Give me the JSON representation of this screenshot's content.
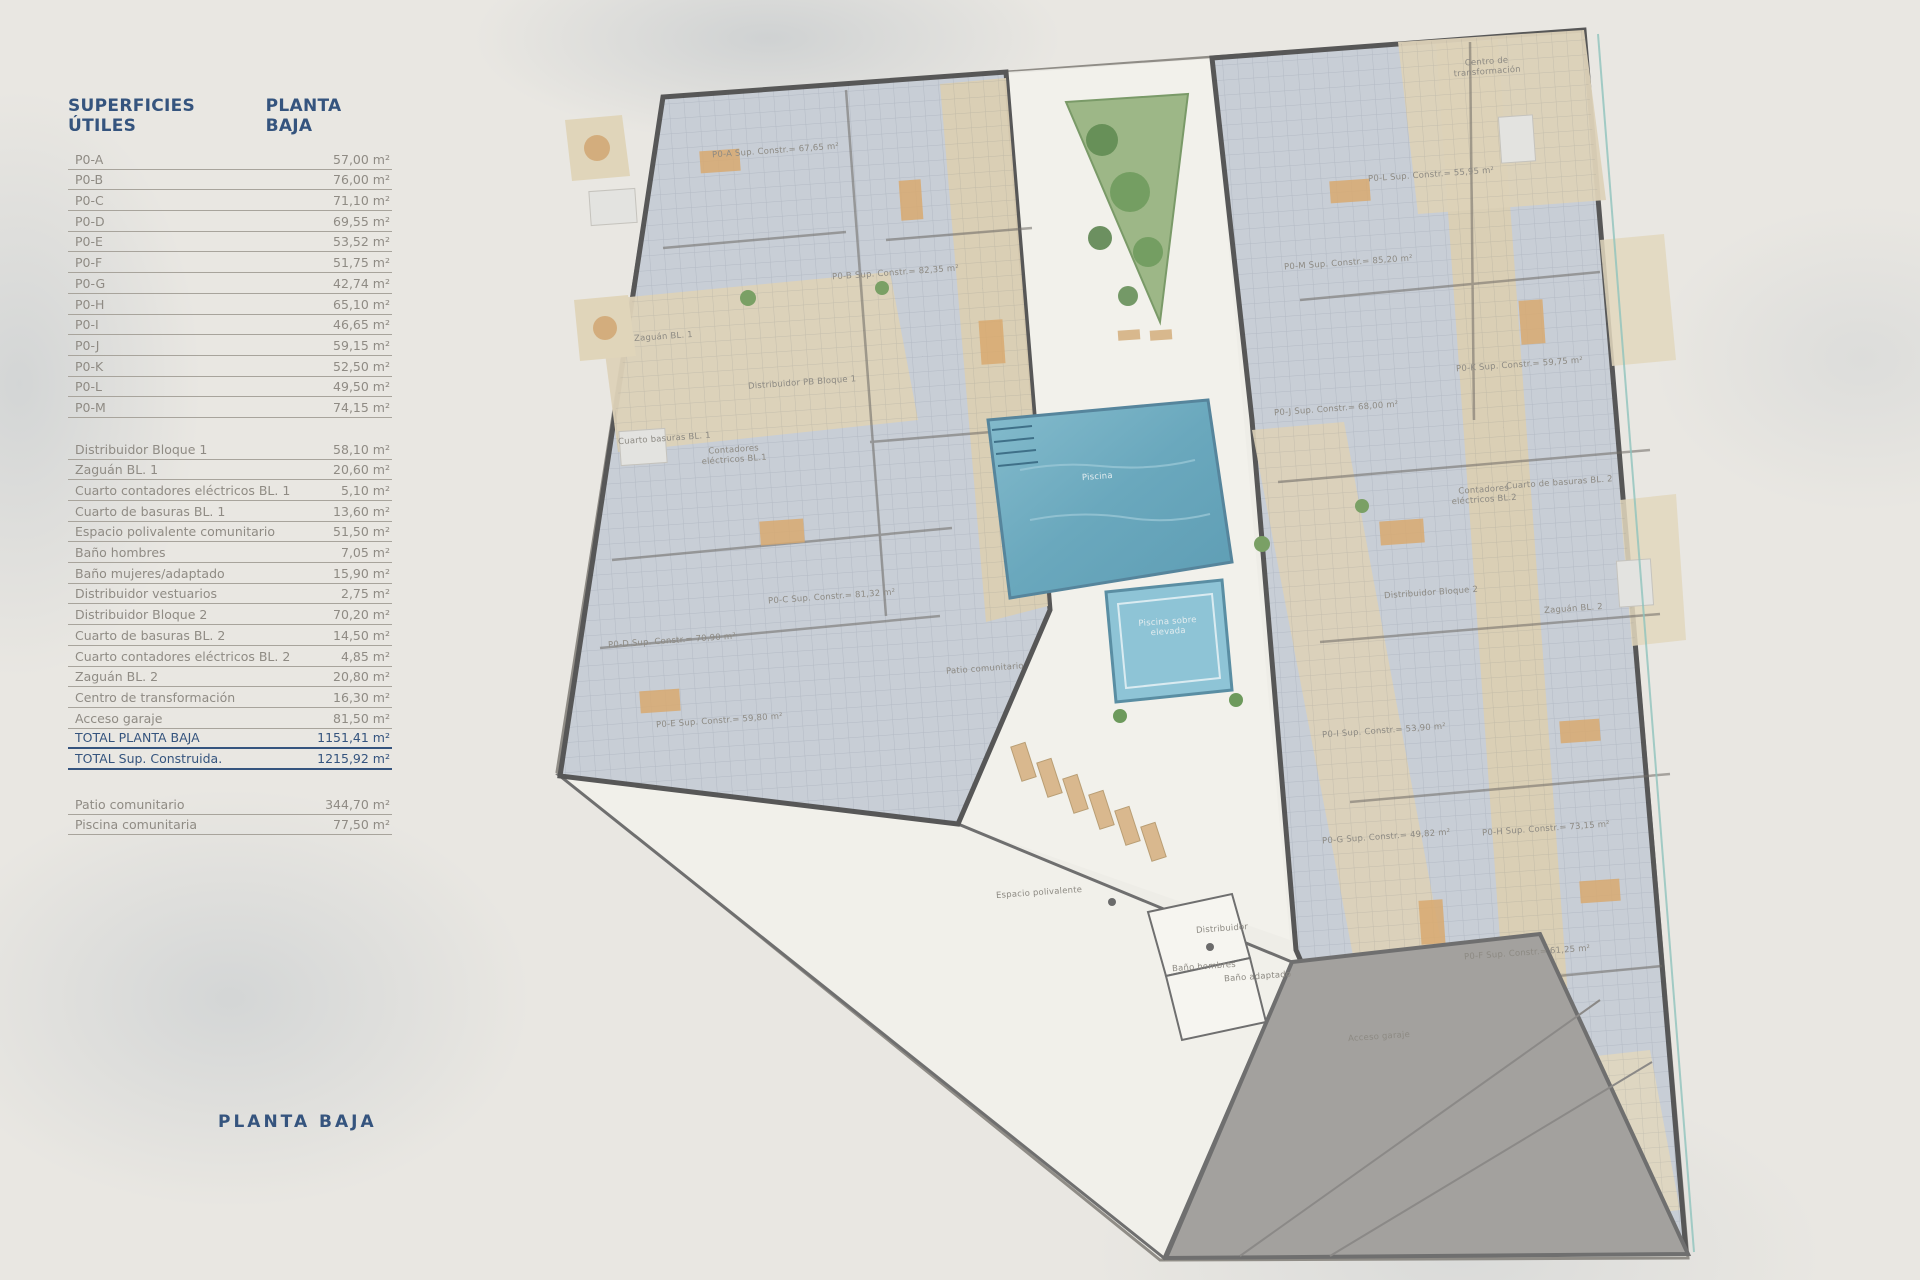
{
  "table": {
    "title_left": "SUPERFICIES ÚTILES",
    "title_right": "PLANTA BAJA",
    "apartments": [
      {
        "label": "P0-A",
        "value": "57,00 m²"
      },
      {
        "label": "P0-B",
        "value": "76,00 m²"
      },
      {
        "label": "P0-C",
        "value": "71,10 m²"
      },
      {
        "label": "P0-D",
        "value": "69,55 m²"
      },
      {
        "label": "P0-E",
        "value": "53,52 m²"
      },
      {
        "label": "P0-F",
        "value": "51,75 m²"
      },
      {
        "label": "P0-G",
        "value": "42,74 m²"
      },
      {
        "label": "P0-H",
        "value": "65,10 m²"
      },
      {
        "label": "P0-I",
        "value": "46,65 m²"
      },
      {
        "label": "P0-J",
        "value": "59,15 m²"
      },
      {
        "label": "P0-K",
        "value": "52,50 m²"
      },
      {
        "label": "P0-L",
        "value": "49,50 m²"
      },
      {
        "label": "P0-M",
        "value": "74,15 m²"
      }
    ],
    "common": [
      {
        "label": "Distribuidor Bloque 1",
        "value": "58,10 m²"
      },
      {
        "label": "Zaguán BL. 1",
        "value": "20,60 m²"
      },
      {
        "label": "Cuarto contadores eléctricos BL. 1",
        "value": "5,10 m²"
      },
      {
        "label": "Cuarto de basuras BL. 1",
        "value": "13,60 m²"
      },
      {
        "label": "Espacio polivalente comunitario",
        "value": "51,50 m²"
      },
      {
        "label": "Baño hombres",
        "value": "7,05 m²"
      },
      {
        "label": "Baño mujeres/adaptado",
        "value": "15,90 m²"
      },
      {
        "label": "Distribuidor vestuarios",
        "value": "2,75 m²"
      },
      {
        "label": "Distribuidor Bloque 2",
        "value": "70,20 m²"
      },
      {
        "label": "Cuarto de basuras BL. 2",
        "value": "14,50 m²"
      },
      {
        "label": "Cuarto contadores eléctricos BL. 2",
        "value": "4,85 m²"
      },
      {
        "label": "Zaguán BL. 2",
        "value": "20,80 m²"
      },
      {
        "label": "Centro de transformación",
        "value": "16,30 m²"
      },
      {
        "label": "Acceso garaje",
        "value": "81,50 m²"
      }
    ],
    "totals": [
      {
        "label": "TOTAL PLANTA BAJA",
        "value": "1151,41 m²"
      },
      {
        "label": "TOTAL Sup. Construida.",
        "value": "1215,92 m²"
      }
    ],
    "outdoor": [
      {
        "label": "Patio comunitario",
        "value": "344,70 m²"
      },
      {
        "label": "Piscina comunitaria",
        "value": "77,50 m²"
      }
    ]
  },
  "footer_title": "PLANTA BAJA",
  "plan": {
    "labels": [
      "P0-A Sup. Constr.= 67,65 m²",
      "P0-B Sup. Constr.= 82,35 m²",
      "P0-C Sup. Constr.= 81,32 m²",
      "P0-D Sup. Constr.= 70,90 m²",
      "P0-E Sup. Constr.= 59,80 m²",
      "P0-F Sup. Constr.= 61,25 m²",
      "P0-G Sup. Constr.= 49,82 m²",
      "P0-H Sup. Constr.= 73,15 m²",
      "P0-I Sup. Constr.= 53,90 m²",
      "P0-J Sup. Constr.= 68,00 m²",
      "P0-K Sup. Constr.= 59,75 m²",
      "P0-L Sup. Constr.= 55,95 m²",
      "P0-M Sup. Constr.= 85,20 m²",
      "Centro de transformación",
      "Zaguán BL. 1",
      "Distribuidor PB Bloque 1",
      "Cuarto basuras BL. 1",
      "Contadores eléctricos BL.1",
      "Cuarto de basuras BL. 2",
      "Contadores eléctricos BL.2",
      "Distribuidor Bloque 2",
      "Zaguán BL. 2",
      "Piscina",
      "Piscina sobre elevada",
      "Patio comunitario",
      "Espacio polivalente",
      "Distribuidor",
      "Baño hombres",
      "Baño adaptado",
      "Acceso garaje"
    ]
  },
  "colors": {
    "accent_blue": "#35547e",
    "row_gray": "#8f8b84",
    "pool_blue": "#6fa8b6",
    "block_gray_blue": "#c8ced6",
    "corridor_tan": "#dbcfb3",
    "garden_green": "#9db787",
    "garage_gray": "#a3a19e"
  }
}
